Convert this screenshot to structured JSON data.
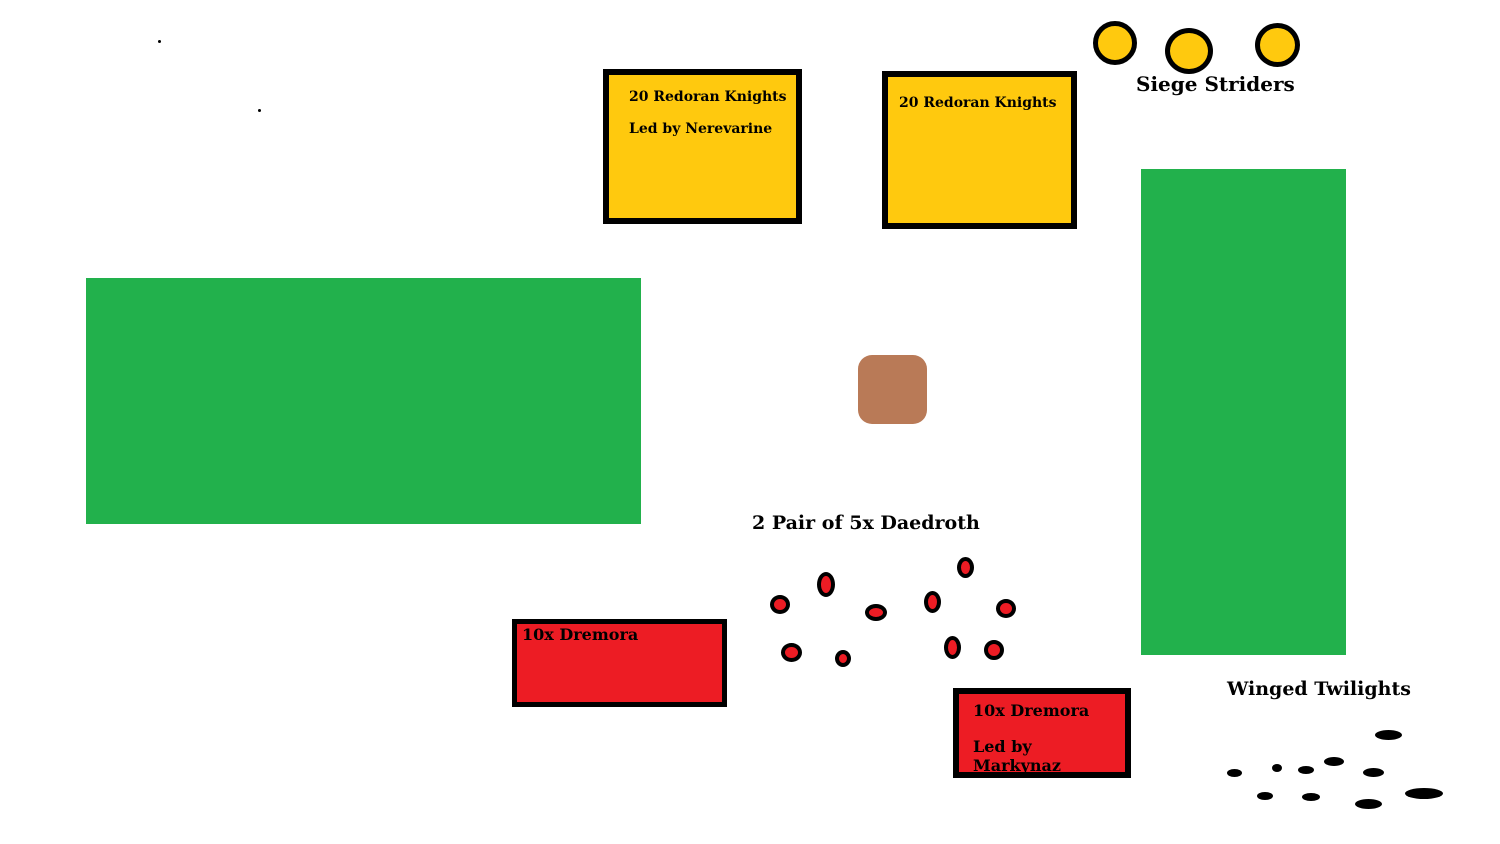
{
  "colors": {
    "gold": "#FFC90E",
    "green": "#22B14C",
    "red": "#ED1C24",
    "brown": "#B97A57",
    "black": "#000000",
    "background": "#FFFFFF"
  },
  "labels": {
    "siege_striders": "Siege Striders",
    "daedroth": "2 Pair of 5x Daedroth",
    "winged_twilights": "Winged Twilights"
  },
  "boxes": {
    "redoran_knights_1": {
      "line1": "20 Redoran Knights",
      "line2": "Led by Nerevarine"
    },
    "redoran_knights_2": {
      "line1": "20 Redoran Knights"
    },
    "dremora_1": {
      "line1": "10x Dremora"
    },
    "dremora_2": {
      "line1": "10x Dremora",
      "line2": "Led by Markynaz"
    }
  },
  "counts": {
    "siege_striders": 3,
    "daedroth": 10,
    "winged_twilights": 10
  },
  "markers": {
    "siege_striders": [
      {
        "x": 1093,
        "y": 21,
        "w": 44,
        "h": 44
      },
      {
        "x": 1165,
        "y": 28,
        "w": 48,
        "h": 46
      },
      {
        "x": 1255,
        "y": 23,
        "w": 45,
        "h": 44
      }
    ],
    "daedroth": [
      {
        "x": 770,
        "y": 595,
        "w": 20,
        "h": 19
      },
      {
        "x": 817,
        "y": 572,
        "w": 18,
        "h": 25
      },
      {
        "x": 865,
        "y": 604,
        "w": 22,
        "h": 17
      },
      {
        "x": 924,
        "y": 591,
        "w": 17,
        "h": 22
      },
      {
        "x": 957,
        "y": 557,
        "w": 17,
        "h": 21
      },
      {
        "x": 996,
        "y": 599,
        "w": 20,
        "h": 19
      },
      {
        "x": 781,
        "y": 643,
        "w": 21,
        "h": 19
      },
      {
        "x": 835,
        "y": 650,
        "w": 16,
        "h": 17
      },
      {
        "x": 944,
        "y": 636,
        "w": 17,
        "h": 23
      },
      {
        "x": 984,
        "y": 640,
        "w": 20,
        "h": 20
      }
    ],
    "winged_twilights": [
      {
        "x": 1227,
        "y": 769,
        "w": 15,
        "h": 8
      },
      {
        "x": 1272,
        "y": 764,
        "w": 10,
        "h": 8
      },
      {
        "x": 1298,
        "y": 766,
        "w": 16,
        "h": 8
      },
      {
        "x": 1324,
        "y": 757,
        "w": 20,
        "h": 9
      },
      {
        "x": 1375,
        "y": 730,
        "w": 27,
        "h": 10
      },
      {
        "x": 1363,
        "y": 768,
        "w": 21,
        "h": 9
      },
      {
        "x": 1257,
        "y": 792,
        "w": 16,
        "h": 8
      },
      {
        "x": 1302,
        "y": 793,
        "w": 18,
        "h": 8
      },
      {
        "x": 1355,
        "y": 799,
        "w": 27,
        "h": 10
      },
      {
        "x": 1405,
        "y": 788,
        "w": 38,
        "h": 11
      }
    ],
    "stray_dots": [
      {
        "x": 158,
        "y": 40,
        "w": 3,
        "h": 3
      },
      {
        "x": 258,
        "y": 109,
        "w": 3,
        "h": 3
      }
    ]
  }
}
